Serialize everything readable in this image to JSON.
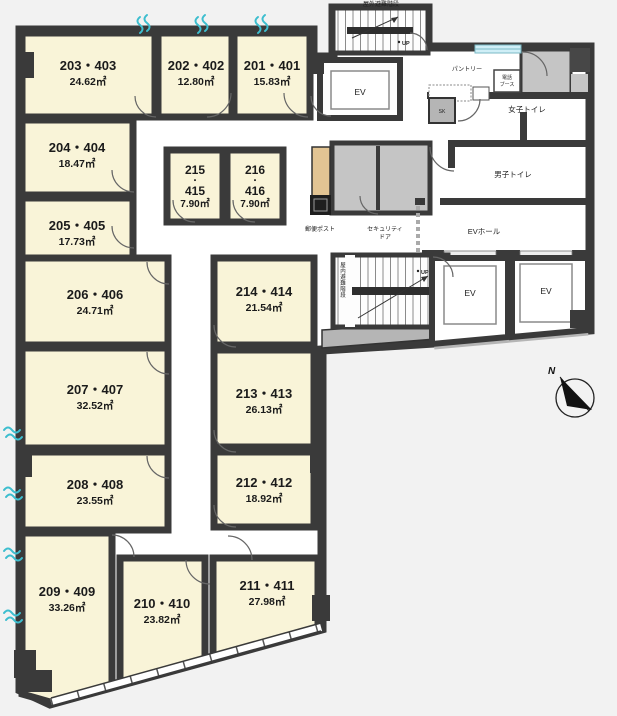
{
  "title": "フロア平面図 (2F・4F)",
  "colors": {
    "background": "#f2f2f2",
    "wall": "#3a3a3a",
    "room_fill": "#f9f4d8",
    "common_fill": "#ffffff",
    "utility_gray": "#c5c5c5",
    "accent_cyan": "#3dbecf",
    "mailpost_beige": "#e2c493"
  },
  "rooms": [
    {
      "name": "203・403",
      "area": "24.62㎡"
    },
    {
      "name": "202・402",
      "area": "12.80㎡"
    },
    {
      "name": "201・401",
      "area": "15.83㎡"
    },
    {
      "name": "204・404",
      "area": "18.47㎡"
    },
    {
      "name": "205・405",
      "area": "17.73㎡"
    },
    {
      "name": "206・406",
      "area": "24.71㎡"
    },
    {
      "name": "207・407",
      "area": "32.52㎡"
    },
    {
      "name": "208・408",
      "area": "23.55㎡"
    },
    {
      "name": "209・409",
      "area": "33.26㎡"
    },
    {
      "name": "210・410",
      "area": "23.82㎡"
    },
    {
      "name": "211・411",
      "area": "27.98㎡"
    },
    {
      "name": "214・414",
      "area": "21.54㎡"
    },
    {
      "name": "213・413",
      "area": "26.13㎡"
    },
    {
      "name": "212・412",
      "area": "18.92㎡"
    }
  ],
  "small_rooms": [
    {
      "num_top": "215",
      "dot": "・",
      "num_bottom": "415",
      "area": "7.90㎡"
    },
    {
      "num_top": "216",
      "dot": "・",
      "num_bottom": "416",
      "area": "7.90㎡"
    }
  ],
  "facilities": {
    "ev": "EV",
    "ev_hall": "EVホール",
    "pantry": "パントリー",
    "phone_booth_line1": "電話",
    "phone_booth_line2": "ブース",
    "womens_toilet": "女子トイレ",
    "mens_toilet": "男子トイレ",
    "sk": "SK",
    "mail_post": "郵便ポスト",
    "security_door_line1": "セキュリティ",
    "security_door_line2": "ドア",
    "outdoor_stairs": "屋外避難階段",
    "indoor_stairs": "屋内避難階段",
    "up": "UP"
  },
  "compass": {
    "north_label": "N"
  }
}
